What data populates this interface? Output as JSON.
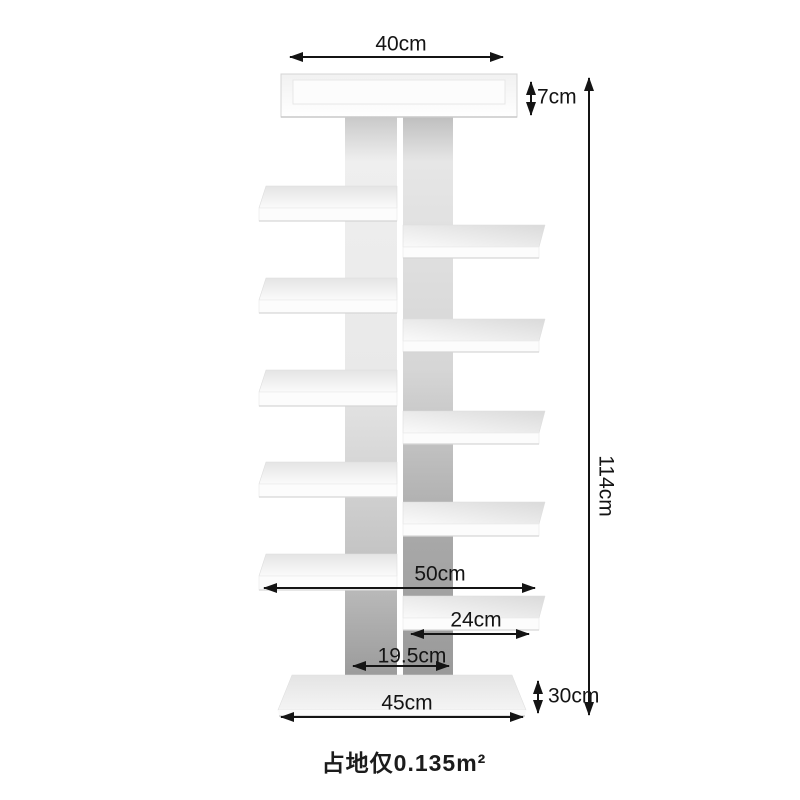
{
  "figure": {
    "subject": "white tree bookshelf dimension diagram"
  },
  "dimensions": {
    "top_width": "40cm",
    "top_tray_height": "7cm",
    "total_height": "114cm",
    "shelf_span_width": "50cm",
    "branch_shelf_length": "24cm",
    "trunk_width": "19.5cm",
    "base_width": "45cm",
    "base_depth": "30cm"
  },
  "caption": "占地仅0.135m²",
  "colors": {
    "background": "#ffffff",
    "dimension_line": "#141414",
    "label_text": "#141414",
    "furniture_white": "#fdfdfd",
    "shadow_gray": "#9b9b9b"
  }
}
